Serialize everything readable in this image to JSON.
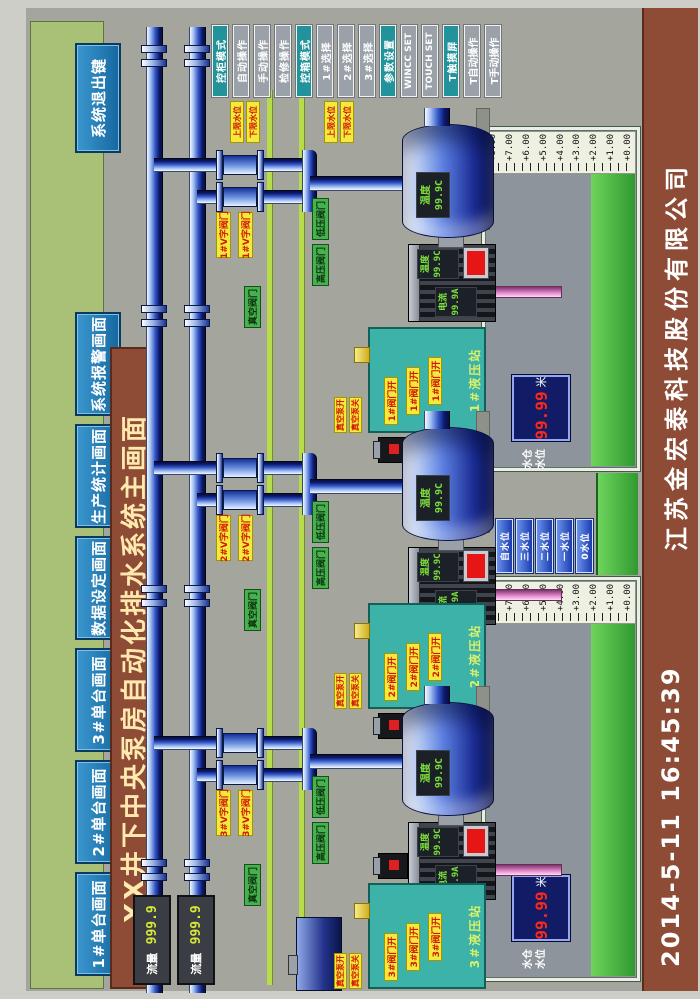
{
  "title": "XX井下中央泵房自动化排水系统主画面",
  "nav": {
    "buttons": [
      "1#单台画面",
      "2#单台画面",
      "3#单台画面",
      "数据设定画面",
      "生产统计画面",
      "系统报警画面"
    ],
    "exit": "系统退出键"
  },
  "modes": [
    {
      "label": "控柜模式",
      "active": true
    },
    {
      "label": "自动操作",
      "active": false
    },
    {
      "label": "手动操作",
      "active": false
    },
    {
      "label": "检修操作",
      "active": false
    },
    {
      "label": "控箱模式",
      "active": true
    },
    {
      "label": "1#选择",
      "active": false
    },
    {
      "label": "2#选择",
      "active": false
    },
    {
      "label": "3#选择",
      "active": false
    },
    {
      "label": "参数设置",
      "active": true
    },
    {
      "label": "WINCC SET",
      "active": false
    },
    {
      "label": "TOUCH SET",
      "active": false
    },
    {
      "label": "T触摸屏",
      "active": true
    },
    {
      "label": "T自动操作",
      "active": false
    },
    {
      "label": "T手动操作",
      "active": false
    }
  ],
  "atags": [
    "上限水位",
    "下限水位",
    "上限水位",
    "下限水位"
  ],
  "flow": [
    {
      "label": "流量",
      "value": "999.9"
    },
    {
      "label": "流量",
      "value": "999.9"
    }
  ],
  "pumps": [
    {
      "id": "1#",
      "temp_label": "温度",
      "temp_value": "99.9C",
      "motor": {
        "current_label": "电流",
        "current_value": "99.9A",
        "temp_label": "温度",
        "temp_value": "99.9C"
      },
      "v_tags": [
        "1#V字阀门",
        "1#V字阀门"
      ],
      "valve_labels": [
        "高压阀门",
        "低压阀门",
        "真空阀门"
      ],
      "station": {
        "title": "1#液压站",
        "tags": [
          "1#阀门开",
          "1#阀门开",
          "1#阀门开"
        ],
        "side_tags": [
          "真空泵开",
          "真空泵关"
        ]
      }
    },
    {
      "id": "2#",
      "temp_label": "温度",
      "temp_value": "99.9C",
      "motor": {
        "current_label": "电流",
        "current_value": "99.9A",
        "temp_label": "温度",
        "temp_value": "99.9C"
      },
      "v_tags": [
        "2#V字阀门",
        "2#V字阀门"
      ],
      "valve_labels": [
        "高压阀门",
        "低压阀门",
        "真空阀门"
      ],
      "station": {
        "title": "2#液压站",
        "tags": [
          "2#阀门开",
          "2#阀门开",
          "2#阀门开"
        ],
        "side_tags": [
          "真空泵开",
          "真空泵关"
        ]
      }
    },
    {
      "id": "3#",
      "temp_label": "温度",
      "temp_value": "99.9C",
      "motor": {
        "current_label": "电流",
        "current_value": "99.9A",
        "temp_label": "温度",
        "temp_value": "99.9C"
      },
      "v_tags": [
        "3#V字阀门",
        "3#V字阀门"
      ],
      "valve_labels": [
        "高压阀门",
        "低压阀门",
        "真空阀门"
      ],
      "station": {
        "title": "3#液压站",
        "tags": [
          "3#阀门开",
          "3#阀门开",
          "3#阀门开"
        ],
        "side_tags": [
          "真空泵开",
          "真空泵关"
        ]
      }
    }
  ],
  "tanks": [
    {
      "scale": [
        "+8.00",
        "+7.00",
        "+6.00",
        "+5.00",
        "+4.00",
        "+3.00",
        "+2.00",
        "+1.00",
        "+0.00"
      ],
      "label1": "水仓",
      "label2": "水位",
      "level": "99.99",
      "unit": "米"
    },
    {
      "scale": [
        "+8.00",
        "+7.00",
        "+6.00",
        "+5.00",
        "+4.00",
        "+3.00",
        "+2.00",
        "+1.00",
        "+0.00"
      ],
      "label1": "水仓",
      "label2": "水位",
      "level": "99.99",
      "unit": "米"
    }
  ],
  "levels": [
    "自水位",
    "三水位",
    "二水位",
    "一水位",
    "0水位"
  ],
  "footer": {
    "datetime": "2014-5-11  16:45:39",
    "company": "江苏金宏泰科技股份有限公司"
  },
  "colors": {
    "nav_green": "#a9c177",
    "button_blue": "#1779b8",
    "banner_brown": "#8e4c36",
    "mode_teal": "#23939b",
    "mode_gray": "#9aa1a8",
    "pipe_blue": "#1a3fb0",
    "water_green": "#4fc24a",
    "pink_pipe": "#c86ab4",
    "alarm_value_red": "#ff2818",
    "tag_yellow": "#f2ea3c"
  }
}
